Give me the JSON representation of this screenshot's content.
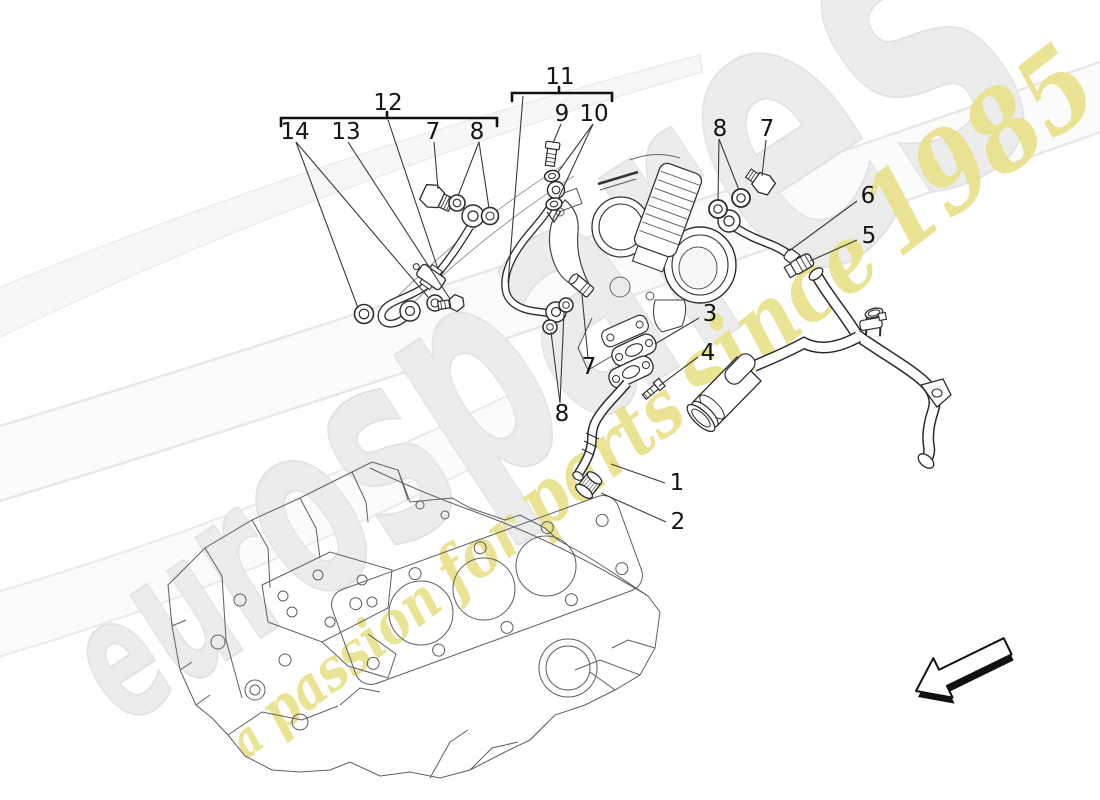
{
  "watermark": {
    "brand_letters": [
      "e",
      "u",
      "r",
      "o",
      "s",
      "p",
      "a",
      "r",
      "e",
      "s"
    ],
    "tagline_words": [
      "a",
      "passion",
      "for",
      "parts",
      "since",
      "1985"
    ],
    "brand_color": "#ececec",
    "brand_edge_color": "#e2e2e2",
    "tagline_color": "#e9e189"
  },
  "callouts": {
    "n1": "1",
    "n2": "2",
    "n3": "3",
    "n4": "4",
    "n5": "5",
    "n6": "6",
    "n7": "7",
    "n8": "8",
    "n9": "9",
    "n10": "10",
    "n11": "11",
    "n12": "12",
    "n13": "13",
    "n14": "14"
  }
}
